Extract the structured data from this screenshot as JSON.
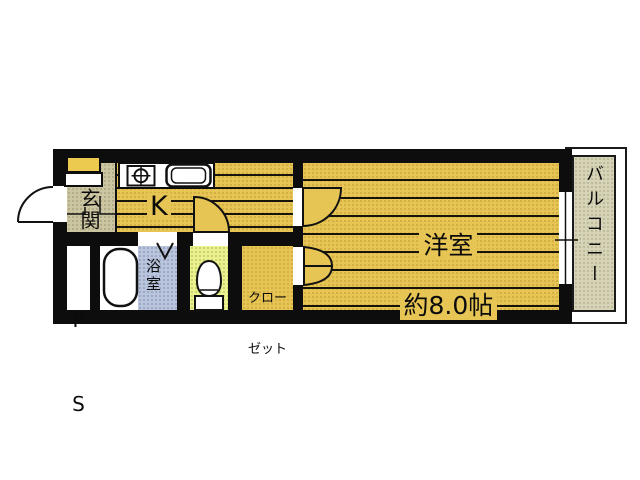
{
  "plan": {
    "title": "apartment-floor-plan",
    "rooms": {
      "genkan": {
        "label": "玄関"
      },
      "kitchen": {
        "label": "K"
      },
      "western_room": {
        "label": "洋室",
        "size_label": "約8.0帖"
      },
      "pipe_space": {
        "label": "PS",
        "line1": "P",
        "line2": "S"
      },
      "bathroom": {
        "label": "浴室"
      },
      "toilet": {
        "label": ""
      },
      "closet": {
        "label": "クローゼット",
        "line1": "クロー",
        "line2": "ゼット"
      },
      "balcony": {
        "label": "バルコニー"
      }
    },
    "icons": [
      "entrance-door-swing",
      "stove-icon",
      "sink-icon",
      "bathtub-icon",
      "toilet-icon",
      "room-door-swing",
      "folding-door-icon",
      "bath-door-mark",
      "sliding-window-icon",
      "entrance-step-line"
    ],
    "colors": {
      "wall": "#0d0d0d",
      "flooring": "#e7c554",
      "genkan_floor": "#ccc5a2",
      "balcony_floor": "#d7d3b6",
      "bathroom_floor": "#b9c4dd",
      "toilet_floor": "#ebf18f",
      "closet_floor": "#e7c554",
      "fixture_fill": "#ffffff"
    }
  }
}
